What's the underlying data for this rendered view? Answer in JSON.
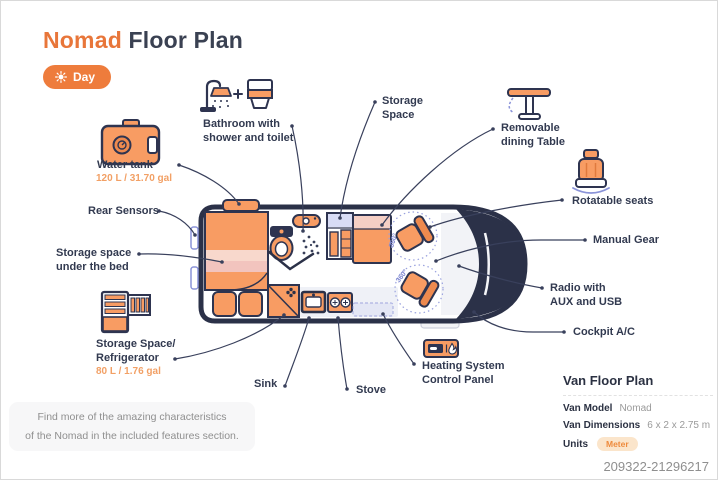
{
  "header": {
    "title_accent": "Nomad",
    "title_rest": " Floor Plan",
    "mode_label": "Day"
  },
  "accent_color": "#ee7c3c",
  "navy_color": "#2e3450",
  "labels": [
    {
      "id": "water-tank",
      "title": "Water tank",
      "capacity": "120 L / 31.70 gal"
    },
    {
      "id": "rear-sensors",
      "title": "Rear Sensors"
    },
    {
      "id": "storage-under-bed",
      "title": "Storage space\nunder the bed"
    },
    {
      "id": "storage-refrigerator",
      "title": "Storage Space/\nRefrigerator",
      "capacity": "80 L / 1.76 gal"
    },
    {
      "id": "bathroom",
      "title": "Bathroom with\nshower and toilet"
    },
    {
      "id": "storage-space",
      "title": "Storage\nSpace"
    },
    {
      "id": "removable-table",
      "title": "Removable\ndining Table"
    },
    {
      "id": "rotatable-seats",
      "title": "Rotatable seats"
    },
    {
      "id": "manual-gear",
      "title": "Manual Gear"
    },
    {
      "id": "radio",
      "title": "Radio with\nAUX and USB"
    },
    {
      "id": "cockpit-ac",
      "title": "Cockpit A/C"
    },
    {
      "id": "heating",
      "title": "Heating System\nControl Panel"
    },
    {
      "id": "sink",
      "title": "Sink"
    },
    {
      "id": "stove",
      "title": "Stove"
    }
  ],
  "plan": {
    "rotation_badge": "360°"
  },
  "note": {
    "text": "Find more of the amazing characteristics\nof the Nomad in the included features section."
  },
  "specs": {
    "heading": "Van Floor Plan",
    "rows": [
      {
        "label": "Van Model",
        "value": "Nomad"
      },
      {
        "label": "Van Dimensions",
        "value": "6 x 2 x 2.75 m"
      },
      {
        "label": "Units",
        "value": "Meter"
      }
    ]
  },
  "watermark": "209322-21296217"
}
